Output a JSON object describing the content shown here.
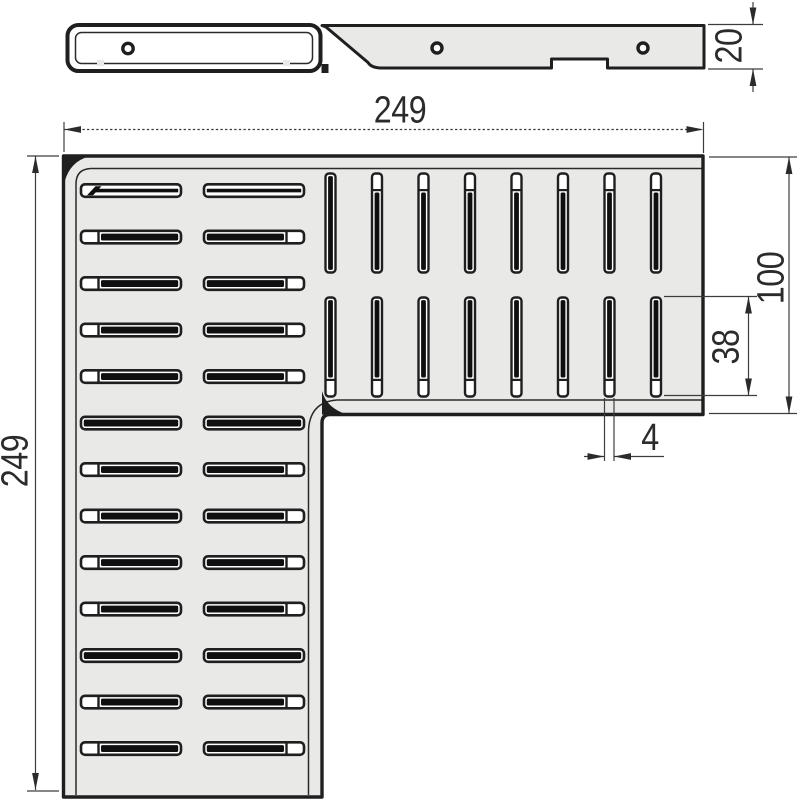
{
  "labels": {
    "dim_top_width": "249",
    "dim_left_height": "249",
    "dim_profile_height": "20",
    "dim_wing_width": "100",
    "dim_slot_length": "38",
    "dim_slot_width": "4"
  },
  "colors": {
    "background": "#ffffff",
    "line": "#1f1f1f",
    "plate_fill": "#e9e9e8",
    "slot_fill": "#0f0f0f",
    "dim_line": "#3d3d3d",
    "text": "#2b2b2b"
  },
  "plan_view": {
    "h_slots": {
      "rows": 13,
      "start_y": 184.3,
      "pitch": 46.5,
      "height": 12.5,
      "width": 100,
      "columns": [
        {
          "x": 81,
          "cell": "left"
        },
        {
          "x": 204,
          "cell": "right"
        }
      ],
      "plain_rows": [
        6,
        11
      ],
      "striped_rows": [
        1
      ]
    },
    "v_slots": {
      "columns_x": [
        325.5,
        372,
        418.5,
        465,
        511.5,
        558,
        604.5,
        651
      ],
      "width": 10,
      "length": 99,
      "rows": [
        {
          "y": 173.5,
          "cell": "top",
          "plain_cols": [
            0
          ]
        },
        {
          "y": 297.5,
          "cell": "bottom",
          "plain_cols": []
        }
      ]
    }
  }
}
